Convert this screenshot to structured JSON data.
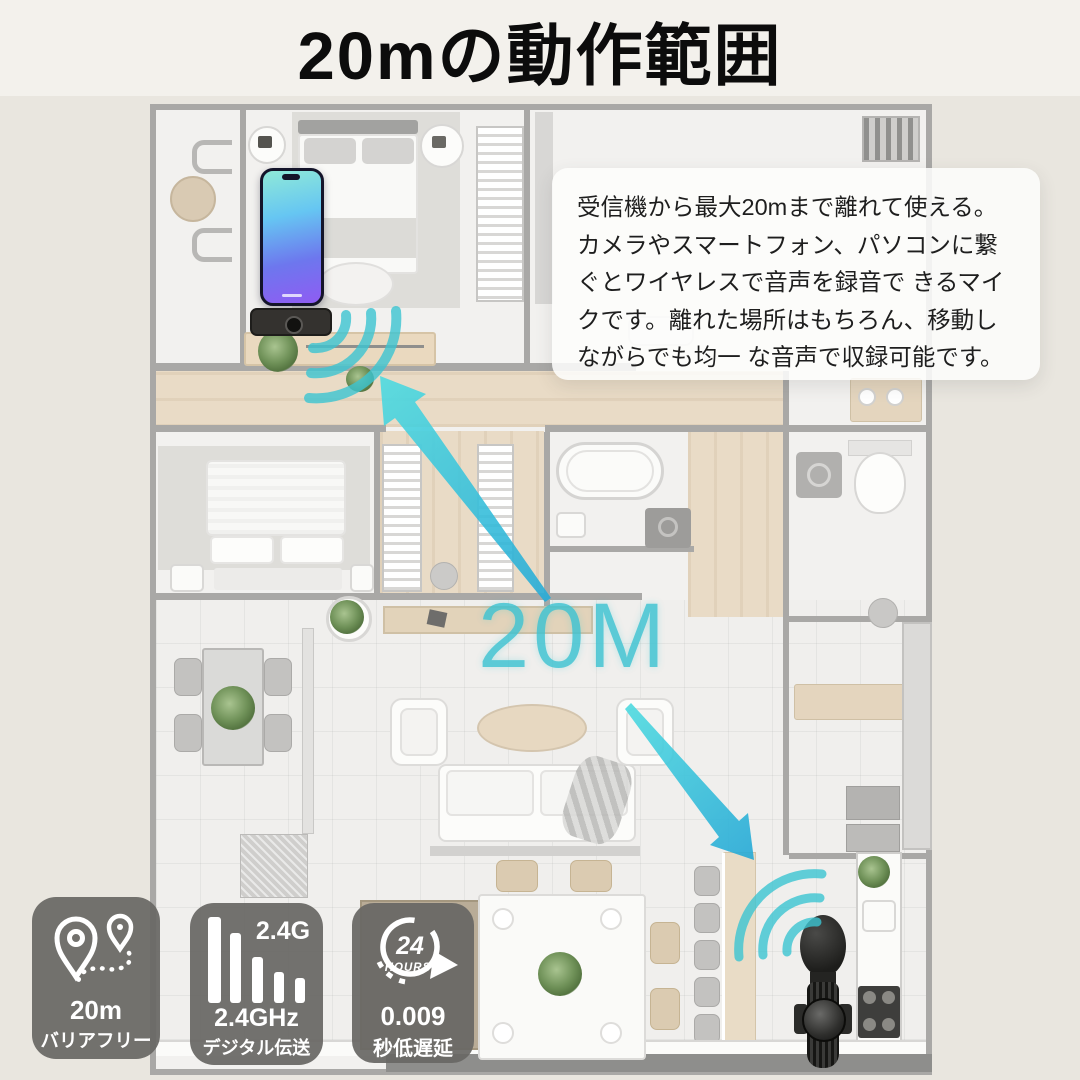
{
  "title": "20mの動作範囲",
  "description": {
    "lines": [
      "受信機から最大20mまで離れて使える。",
      "カメラやスマートフォン、パソコンに繋",
      "ぐとワイヤレスで音声を録音で きるマイ",
      "クです。離れた場所はもちろん、移動し",
      "ながらでも均一 な音声で収録可能です。"
    ]
  },
  "floorplan": {
    "range_label": "20M"
  },
  "badges": {
    "range": {
      "value": "20m",
      "label": "バリアフリー"
    },
    "signal": {
      "tag": "2.4G",
      "value": "2.4GHz",
      "label": "デジタル伝送"
    },
    "latency": {
      "icon_top": "24",
      "icon_sub": "HOURS",
      "value": "0.009",
      "label": "秒低遅延"
    }
  },
  "colors": {
    "accent": "#3cc5d2",
    "badge_bg": "#686764",
    "title": "#0c0c0c"
  }
}
